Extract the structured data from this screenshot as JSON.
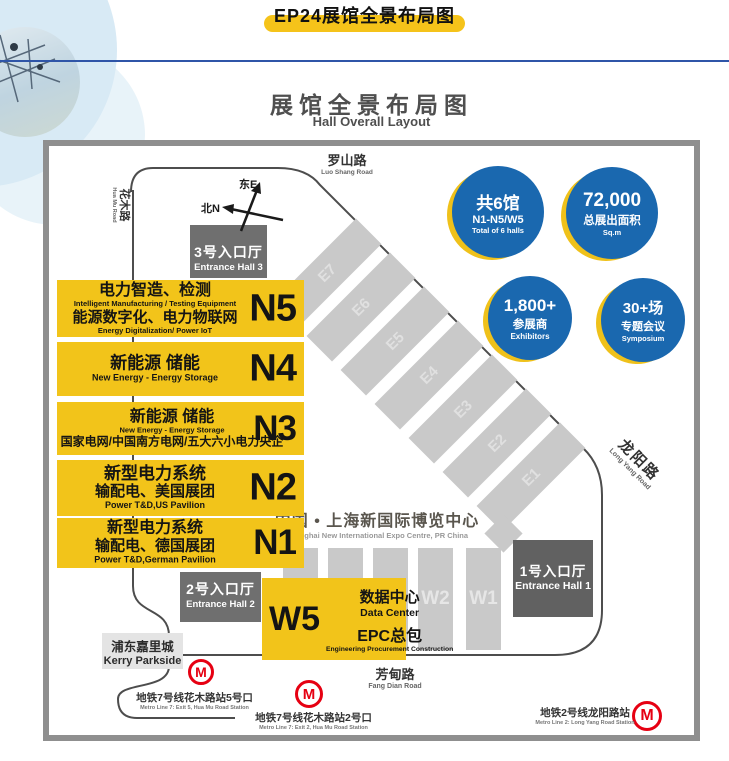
{
  "banner": {
    "title": "EP24展馆全景布局图"
  },
  "heading": {
    "zh": "展馆全景布局图",
    "en": "Hall Overall Layout"
  },
  "stats": [
    {
      "line1": "共6馆",
      "line2": "N1-N5/W5",
      "line3": "Total of 6 halls"
    },
    {
      "line1": "72,000",
      "line2": "总展出面积",
      "line3": "Sq.m"
    },
    {
      "line1": "1,800+",
      "line2": "参展商",
      "line3": "Exhibitors"
    },
    {
      "line1": "30+场",
      "line2": "专题会议",
      "line3": "Symposium"
    }
  ],
  "roads": {
    "luoshan_zh": "罗山路",
    "luoshan_en": "Luo Shang Road",
    "huamu_zh": "花木路",
    "huamu_en": "Hua Mu Road",
    "longyang_zh": "龙阳路",
    "longyang_en": "Long Yang Road",
    "fangdian_zh": "芳甸路",
    "fangdian_en": "Fang Dian Road"
  },
  "compass": {
    "east": "东E",
    "north": "北N"
  },
  "entrance3": {
    "zh": "3号入口厅",
    "en": "Entrance Hall 3"
  },
  "entrance2": {
    "zh": "2号入口厅",
    "en": "Entrance Hall 2"
  },
  "entrance1": {
    "zh": "1号入口厅",
    "en": "Entrance Hall 1"
  },
  "n_halls": [
    {
      "id": "N5",
      "zh1": "电力智造、检测",
      "en1": "Intelligent Manufacturing / Testing Equipment",
      "zh2": "能源数字化、电力物联网",
      "en2": "Energy Digitalization/ Power IoT"
    },
    {
      "id": "N4",
      "zh1": "新能源 储能",
      "en1": "New Energy - Energy Storage"
    },
    {
      "id": "N3",
      "zh1": "新能源 储能",
      "en1": "New Energy - Energy Storage",
      "zh2": "国家电网/中国南方电网/五大六小电力央企"
    },
    {
      "id": "N2",
      "zh1": "新型电力系统",
      "zh2": "输配电、美国展团",
      "en2": "Power T&D,US Pavilion"
    },
    {
      "id": "N1",
      "zh1": "新型电力系统",
      "zh2": "输配电、德国展团",
      "en2": "Power T&D,German Pavilion"
    }
  ],
  "w5": {
    "id": "W5",
    "zh1": "数据中心",
    "en1": "Data Center",
    "zh2": "EPC总包",
    "en2": "Engineering Procurement Construction"
  },
  "east_halls": [
    "E7",
    "E6",
    "E5",
    "E4",
    "E3",
    "E2",
    "E1"
  ],
  "west_halls": [
    "W2",
    "W1"
  ],
  "expo": {
    "zh": "中国 • 上海新国际博览中心",
    "en": "Shanghai New International Expo Centre, PR China"
  },
  "kerry": {
    "zh": "浦东嘉里城",
    "en": "Kerry Parkside"
  },
  "metro": [
    {
      "symbol": "M",
      "zh": "地铁7号线花木路站5号口",
      "en": "Metro Line 7: Exit 5, Hua Mu Road Station"
    },
    {
      "symbol": "M",
      "zh": "地铁7号线花木路站2号口",
      "en": "Metro Line 7: Exit 2, Hua Mu Road Station"
    },
    {
      "symbol": "M",
      "zh": "地铁2号线龙阳路站",
      "en": "Metro Line 2: Long Yang Road Station"
    }
  ],
  "colors": {
    "yellow": "#f2c41a",
    "blue": "#1a68af",
    "dark_gray": "#6f6f6f",
    "hall_gray": "#c9c9c9",
    "metro_red": "#e60012"
  }
}
